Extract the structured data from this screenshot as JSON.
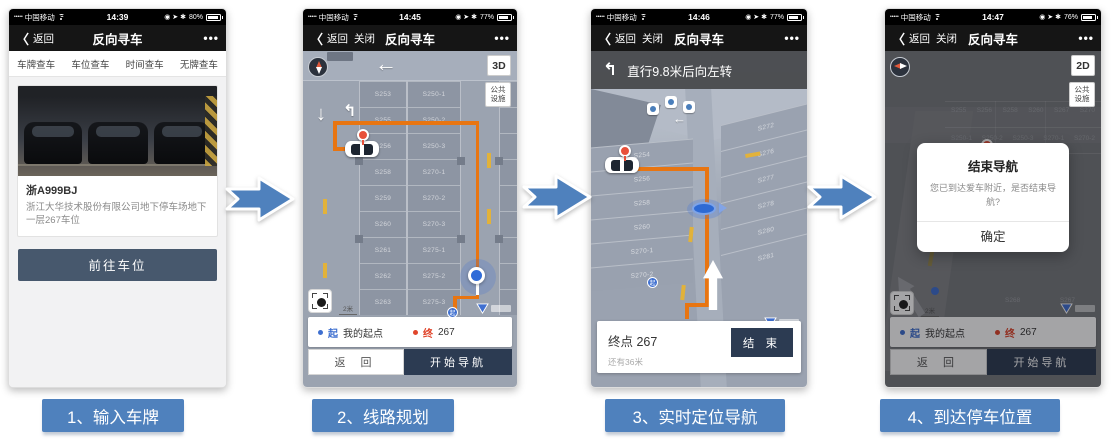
{
  "steps": [
    {
      "label": "1、输入车牌"
    },
    {
      "label": "2、线路规划"
    },
    {
      "label": "3、实时定位导航"
    },
    {
      "label": "4、到达停车位置"
    }
  ],
  "icons": {
    "back_chevron": "〈",
    "more": "•••",
    "signal_dots": "•••••",
    "status_right": "◉ ➤ ✱",
    "left_arrow": "←",
    "down_arrow": "↓",
    "up_arrow": "↑",
    "turn_left_arrow": "↰"
  },
  "p1": {
    "status": {
      "carrier": "中国移动",
      "time": "14:39",
      "battery_pct": "80%"
    },
    "nav": {
      "back": "返回",
      "title": "反向寻车"
    },
    "tabs": [
      "车牌查车",
      "车位查车",
      "时间查车",
      "无牌查车"
    ],
    "card": {
      "plate": "浙A999BJ",
      "desc": "浙江大华技术股份有限公司地下停车场地下一层267车位"
    },
    "go_button": "前往车位"
  },
  "p2": {
    "status": {
      "carrier": "中国移动",
      "time": "14:45",
      "battery_pct": "77%"
    },
    "nav": {
      "back": "返回",
      "close": "关闭",
      "title": "反向寻车"
    },
    "map": {
      "mode": "3D",
      "facility": "公共设施",
      "scale": "2米",
      "start_badge": "起",
      "colA": [
        "S253",
        "S255",
        "S256",
        "S258",
        "S259",
        "S260",
        "S261",
        "S262",
        "S263"
      ],
      "colB": [
        "S250-1",
        "S250-2",
        "S250-3",
        "S270-1",
        "S270-2",
        "S270-3",
        "S275-1",
        "S275-2",
        "S275-3"
      ]
    },
    "panel": {
      "start_tag": "起",
      "start_text": "我的起点",
      "end_tag": "终",
      "end_text": "267",
      "back_button": "返 回",
      "nav_button": "开始导航"
    }
  },
  "p3": {
    "status": {
      "carrier": "中国移动",
      "time": "14:46",
      "battery_pct": "77%"
    },
    "nav": {
      "back": "返回",
      "close": "关闭",
      "title": "反向寻车"
    },
    "instruction": "直行9.8米后向左转",
    "map": {
      "scale": "2米",
      "start_badge": "起",
      "colL": [
        "S254",
        "S256",
        "S258",
        "S260",
        "S270-1",
        "S270-2"
      ],
      "colR": [
        "S272",
        "S276",
        "S277",
        "S278",
        "S280",
        "S281"
      ]
    },
    "panel": {
      "dest": "终点 267",
      "end_button": "结 束",
      "remaining": "还有36米"
    }
  },
  "p4": {
    "status": {
      "carrier": "中国移动",
      "time": "14:47",
      "battery_pct": "76%"
    },
    "nav": {
      "back": "返回",
      "close": "关闭",
      "title": "反向寻车"
    },
    "map": {
      "mode": "2D",
      "facility": "公共设施",
      "scale": "2米",
      "row1": [
        "S255",
        "S256",
        "S258",
        "S260",
        "S267",
        "S270"
      ],
      "row2": [
        "S250-1",
        "S250-2",
        "S250-3",
        "S270-1",
        "S270-2"
      ],
      "row3": [
        "S268",
        "S267"
      ]
    },
    "dialog": {
      "title": "结束导航",
      "message": "您已到达爱车附近，是否结束导航?",
      "confirm": "确定"
    },
    "panel": {
      "start_tag": "起",
      "start_text": "我的起点",
      "end_tag": "终",
      "end_text": "267",
      "back_button": "返 回",
      "nav_button": "开始导航"
    }
  },
  "colors": {
    "step_blue": "#4f81bd",
    "route_orange": "#e87511",
    "button_navy": "#2c3b52",
    "pin_red": "#e8503a",
    "marker_blue": "#2f6bd8"
  }
}
